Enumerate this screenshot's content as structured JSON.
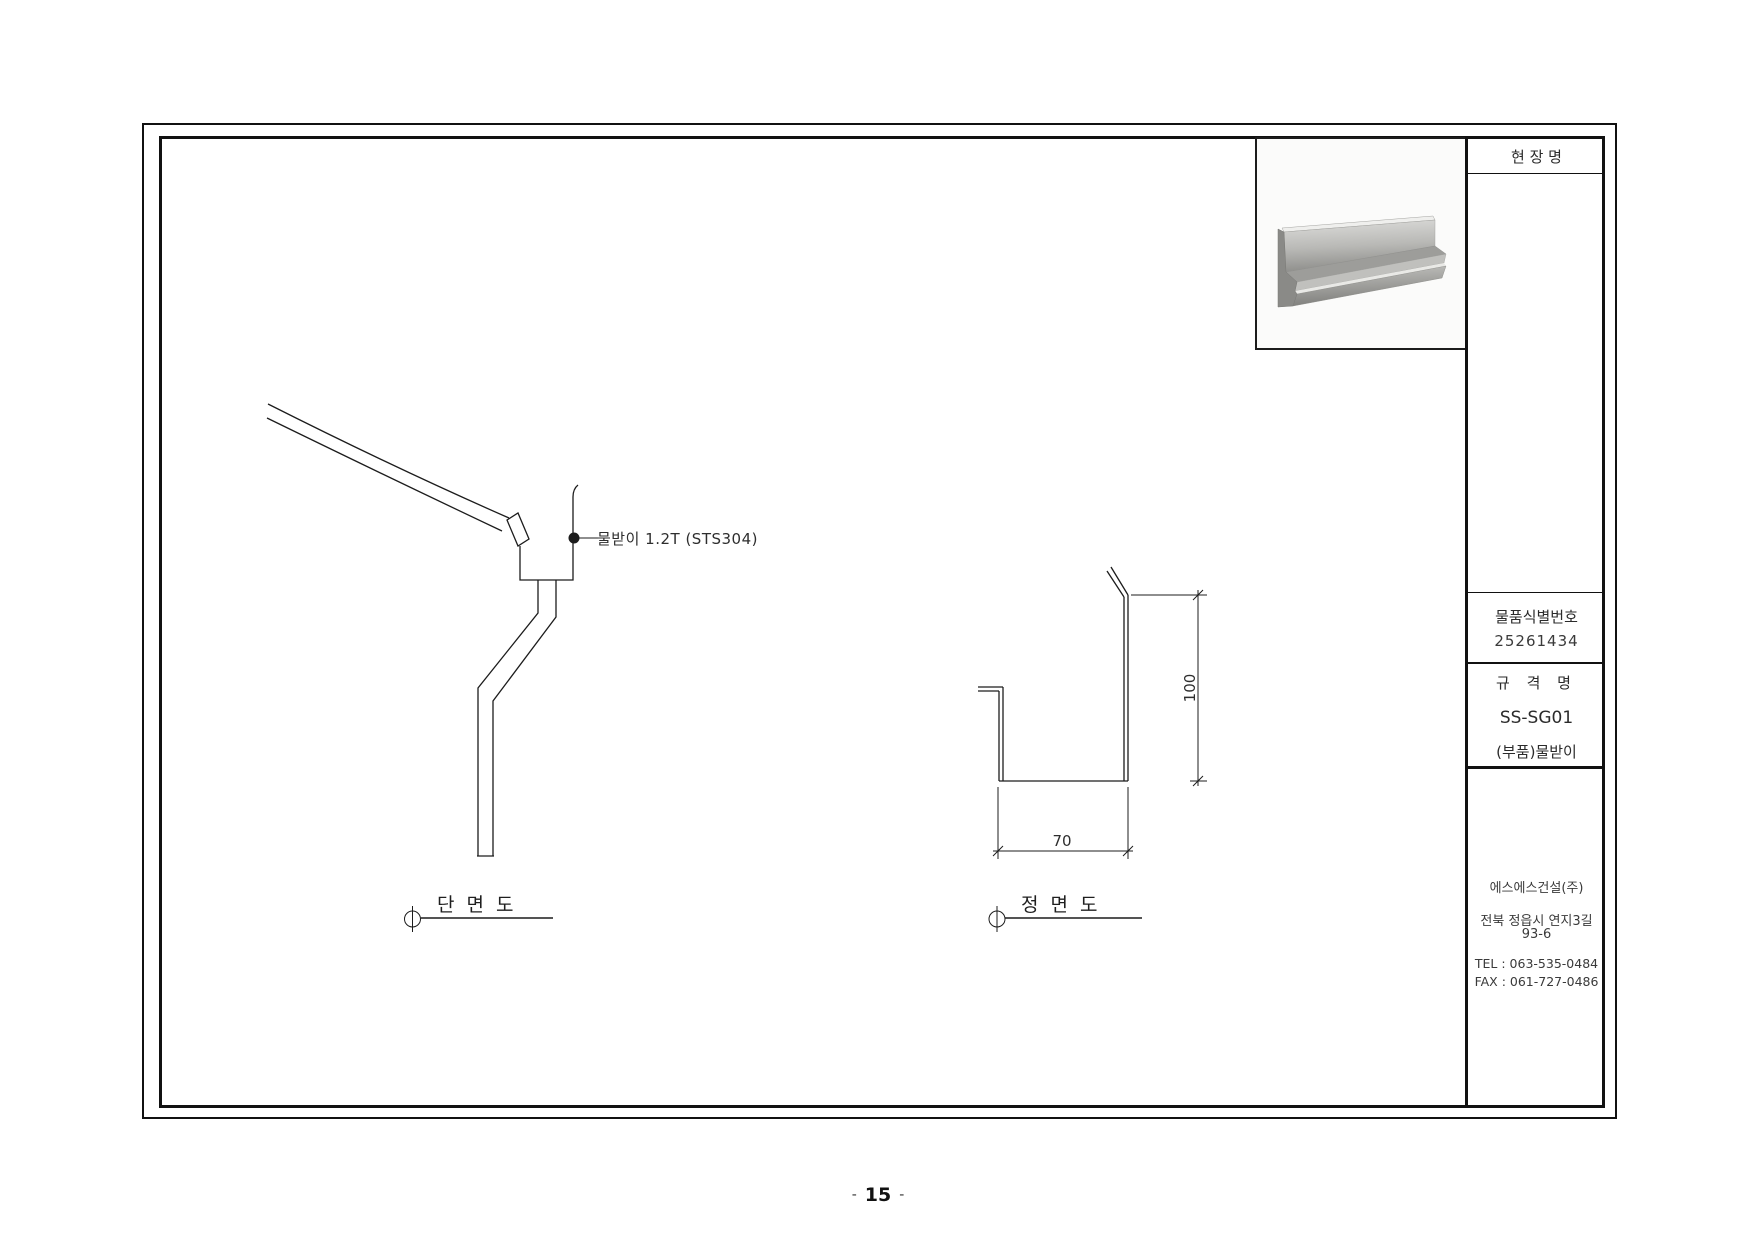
{
  "colors": {
    "line": "#1c1c1c",
    "text": "#2b2b2b",
    "border": "#111111"
  },
  "title_block": {
    "site_name_label": "현 장 명",
    "item_id_label": "물품식별번호",
    "item_id_value": "25261434",
    "spec_label": "규 격 명",
    "spec_model": "SS-SG01",
    "spec_part": "(부품)물받이",
    "company_name": "에스에스건설(주)",
    "company_address_line1": "전북 정읍시 연지3길",
    "company_address_line2": "93-6",
    "company_tel": "TEL : 063-535-0484",
    "company_fax": "FAX : 061-727-0486"
  },
  "views": {
    "section": {
      "label": "단 면 도",
      "annotation": "물받이 1.2T (STS304)"
    },
    "front": {
      "label": "정 면 도",
      "height_dim": "100",
      "width_dim": "70"
    }
  },
  "product_photo": {
    "name": "stainless-gutter-channel-photo"
  },
  "page_footer": {
    "left_dash": "-",
    "page_number": "15",
    "right_dash": "-"
  }
}
